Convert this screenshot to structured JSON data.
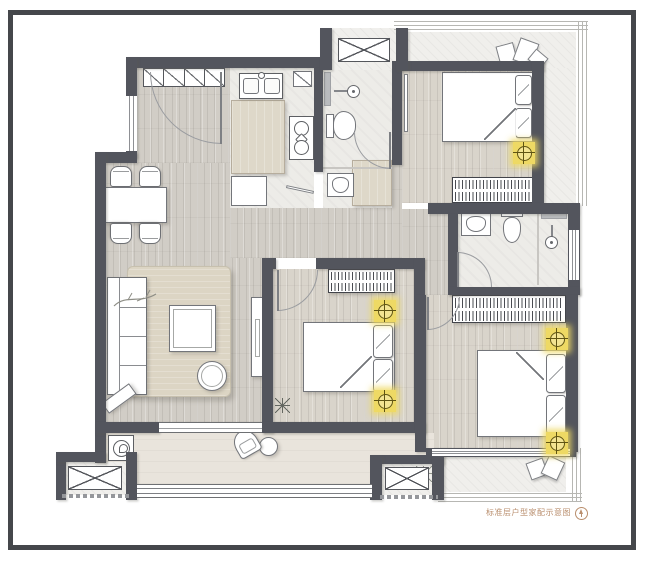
{
  "document": {
    "type": "architectural floor plan",
    "caption": "标准层户型家配示意图",
    "caption_color": "#b98e6d",
    "compass_icon": "north-arrow"
  },
  "palette": {
    "frame": "#45474b",
    "wall": "#53555d",
    "wood_floor_public": "#d1cdc6",
    "wood_floor_bedroom": "#d9d4cb",
    "tile_floor": "#edece8",
    "balcony_floor": "#e9e4dc",
    "terrace_floor": "#f0efec",
    "furniture_fill": "#ffffff",
    "furniture_outline": "#73757a",
    "accent_wood": "#ded8c9",
    "rug": "#dcd5c4",
    "ceiling_light": "#eed964",
    "ceiling_light_ring": "#5f5413"
  },
  "rooms": [
    {
      "id": "entry",
      "label": "entry hall"
    },
    {
      "id": "kitchen",
      "label": "kitchen"
    },
    {
      "id": "bathroom-1",
      "label": "bathroom 1"
    },
    {
      "id": "bedroom-1",
      "label": "bedroom top-right"
    },
    {
      "id": "hallway",
      "label": "hallway"
    },
    {
      "id": "dining-area",
      "label": "dining area"
    },
    {
      "id": "living-room",
      "label": "living room"
    },
    {
      "id": "bedroom-2",
      "label": "bedroom middle"
    },
    {
      "id": "bathroom-2",
      "label": "bathroom 2"
    },
    {
      "id": "bedroom-3",
      "label": "bedroom bottom-right"
    },
    {
      "id": "living-balcony",
      "label": "living balcony"
    },
    {
      "id": "bedroom-balcony",
      "label": "bedroom balcony"
    },
    {
      "id": "terrace",
      "label": "top terrace"
    },
    {
      "id": "ac-platform-top",
      "label": "A/C platform top"
    },
    {
      "id": "ac-platform-left",
      "label": "A/C platform bottom-left"
    },
    {
      "id": "ac-platform-middle",
      "label": "A/C platform bottom-middle"
    }
  ],
  "furniture": {
    "entry": [
      "shoe-cabinet",
      "entry-door"
    ],
    "kitchen": [
      "double-sink",
      "counter-island",
      "gas-stove",
      "base-cabinet",
      "corner-shelf"
    ],
    "bathroom_1": [
      "shower-head",
      "toilet",
      "washbasin",
      "wall-shelf"
    ],
    "bedroom_1": [
      "double-bed",
      "pillows",
      "wardrobe",
      "ceiling-light",
      "door-leaf"
    ],
    "bathroom_2": [
      "washbasin",
      "toilet",
      "shower-head",
      "wall-shelf",
      "window"
    ],
    "bedroom_2": [
      "double-bed",
      "pillows",
      "wardrobe",
      "ceiling-light",
      "ceiling-light",
      "plant"
    ],
    "bedroom_3": [
      "double-bed",
      "pillows",
      "wardrobe",
      "ceiling-light",
      "ceiling-light"
    ],
    "living_room": [
      "sofa",
      "rug",
      "coffee-table",
      "ottoman",
      "tv-cabinet",
      "decor-branch",
      "decor-bench"
    ],
    "dining_area": [
      "dining-table",
      "chair",
      "chair",
      "chair",
      "chair"
    ],
    "hallway": [
      "cabinet"
    ],
    "living_balcony": [
      "washing-machine",
      "lounge-chair",
      "side-table",
      "plant"
    ],
    "bedroom_balcony": [
      "cushions",
      "plant"
    ],
    "terrace": [
      "cushions"
    ]
  },
  "symbols": {
    "ceiling_light_count": 5,
    "ac_unit_count": 3,
    "wardrobe_count": 3,
    "bed_count": 3,
    "toilet_count": 2
  }
}
